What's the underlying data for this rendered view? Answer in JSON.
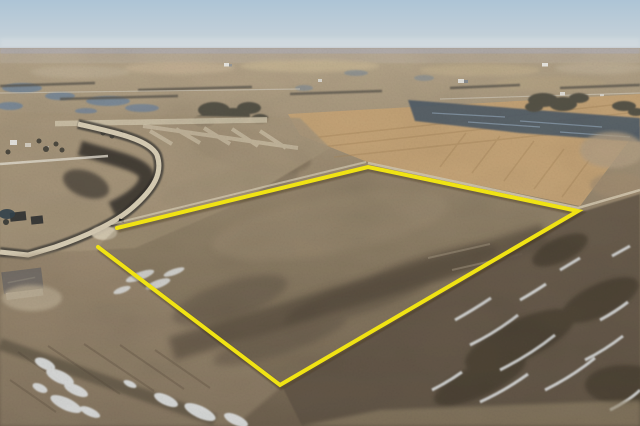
{
  "image": {
    "kind": "aerial drone photograph",
    "subject": "vacant rural acreage outlined for sale beside a new subdivision road",
    "width_px": 640,
    "height_px": 426
  },
  "parcel_boundary": {
    "shape": "open polygon with a gap at the road-access corner",
    "points": "117,228 368,167 578,211 280,385 98,247",
    "color": "#f0e314",
    "stroke_width": "4"
  },
  "palette": {
    "sky_top": "#adc4d6",
    "sky_horizon": "#cdd5d9",
    "far_fields": "#b9ab97",
    "tan_field": "#c5a477",
    "wet_field": "#4f5c68",
    "water": "#74879b",
    "trees": "#565246",
    "ground_dark": "#5f5344",
    "burned": "#2d2b26",
    "road_gravel": "#dcd1b8",
    "snow": "#e4e7e8",
    "house_roof": "#50525a"
  }
}
